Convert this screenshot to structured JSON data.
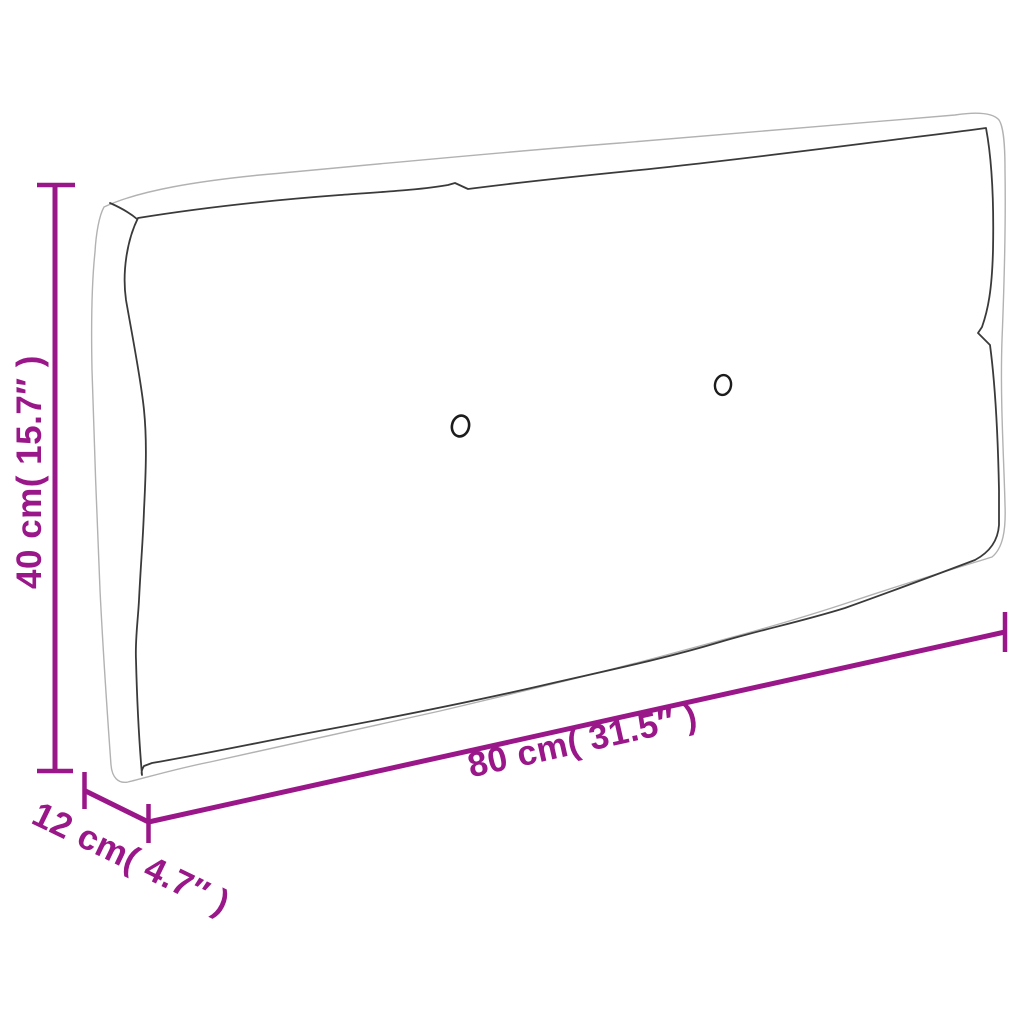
{
  "illustration": {
    "subject": "pallet-cushion-outline",
    "button_count": 2
  },
  "dimensions": {
    "height": {
      "label": "40 cm( 15.7″ )"
    },
    "width": {
      "label": "80 cm( 31.5″ )"
    },
    "depth": {
      "label": "12 cm( 4.7″ )"
    }
  },
  "colors": {
    "dimension_accent": "#9A1789",
    "outline_dark": "#3A3A3A",
    "outline_light": "#B2B2B2",
    "button_stroke": "#1C1C1C",
    "background": "#FFFFFF"
  }
}
